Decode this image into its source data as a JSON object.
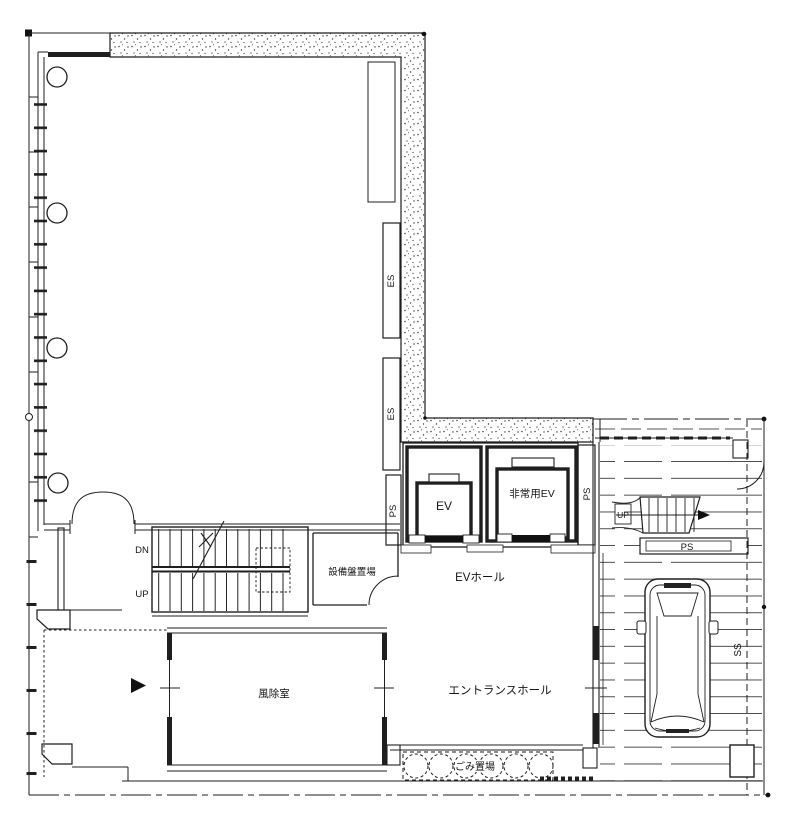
{
  "colors": {
    "line": "#1f1f1f",
    "background": "#ffffff",
    "stipple_dot": "#3a3a3a"
  },
  "labels": {
    "es_upper": "ES",
    "es_lower": "ES",
    "ps_shaft": "PS",
    "ps_elevator": "PS",
    "ps_ramp": "PS",
    "ev": "EV",
    "emergency_ev": "非常用EV",
    "ev_hall": "EVホール",
    "entrance_hall": "エントランスホール",
    "windbreak_room": "風除室",
    "equipment_room": "設備盤置場",
    "garbage_area": "ごみ置場",
    "stair_down": "DN",
    "stair_up": "UP",
    "ramp_up": "UP",
    "ss": "SS"
  }
}
